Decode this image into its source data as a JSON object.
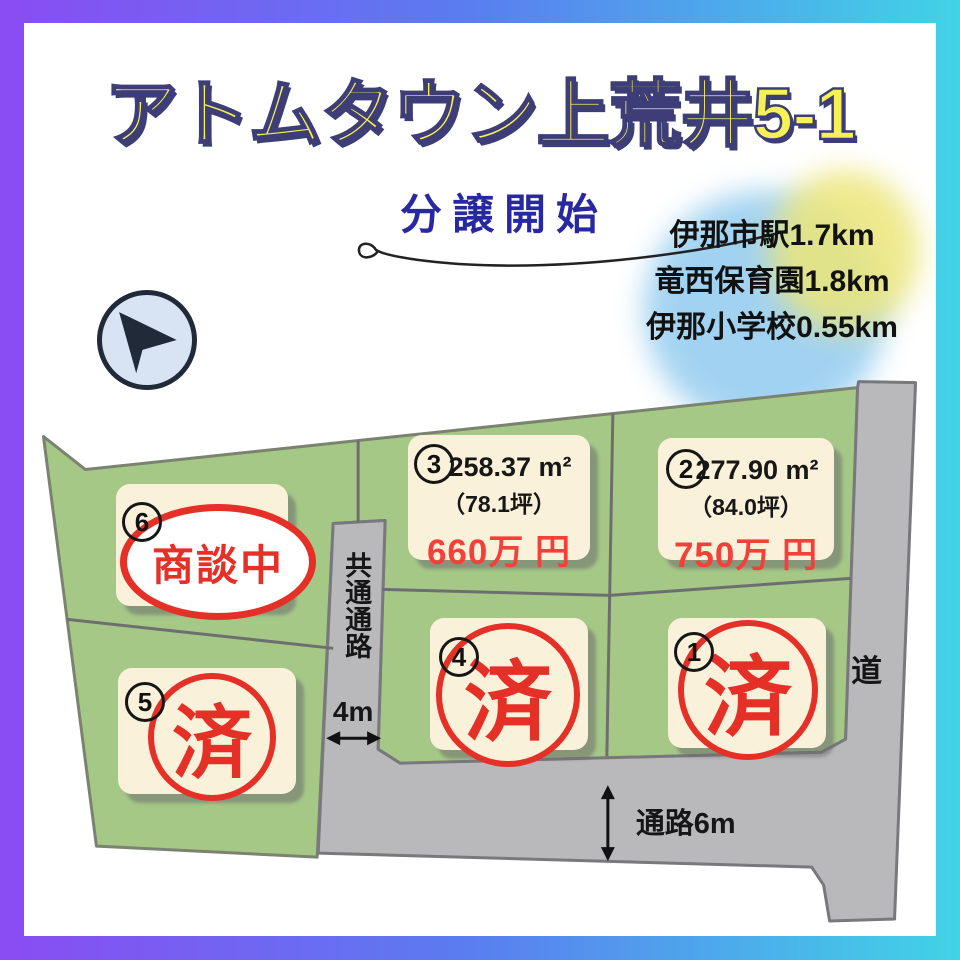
{
  "title": "アトムタウン上荒井5-1",
  "subtitle": "分譲開始",
  "landmarks": [
    "伊那市駅1.7km",
    "竜西保育園1.8km",
    "伊那小学校0.55km"
  ],
  "map": {
    "lots": [
      {
        "number": "1",
        "status": "済"
      },
      {
        "number": "2",
        "area": "277.90 m²",
        "tsubo": "（84.0坪）",
        "price": "750万 円"
      },
      {
        "number": "3",
        "area": "258.37 m²",
        "tsubo": "（78.1坪）",
        "price": "660万 円"
      },
      {
        "number": "4",
        "status": "済"
      },
      {
        "number": "5",
        "status": "済"
      },
      {
        "number": "6",
        "status": "商談中"
      }
    ],
    "labels": {
      "common_passage": "共通通路",
      "common_passage_width": "4m",
      "south_passage": "通路6m",
      "road": "道"
    }
  },
  "colors": {
    "gradient_start": "#8a4cf3",
    "gradient_mid": "#5a7cf0",
    "gradient_end": "#41d3e6",
    "title_yellow": "#f6f154",
    "title_outline": "#3d3d78",
    "subtitle_navy": "#2828a0",
    "land_green": "#a5c887",
    "road_gray": "#b9b9bc",
    "card_cream": "#f9f1d9",
    "stamp_red": "#e53028",
    "price_red": "#f5403a"
  }
}
